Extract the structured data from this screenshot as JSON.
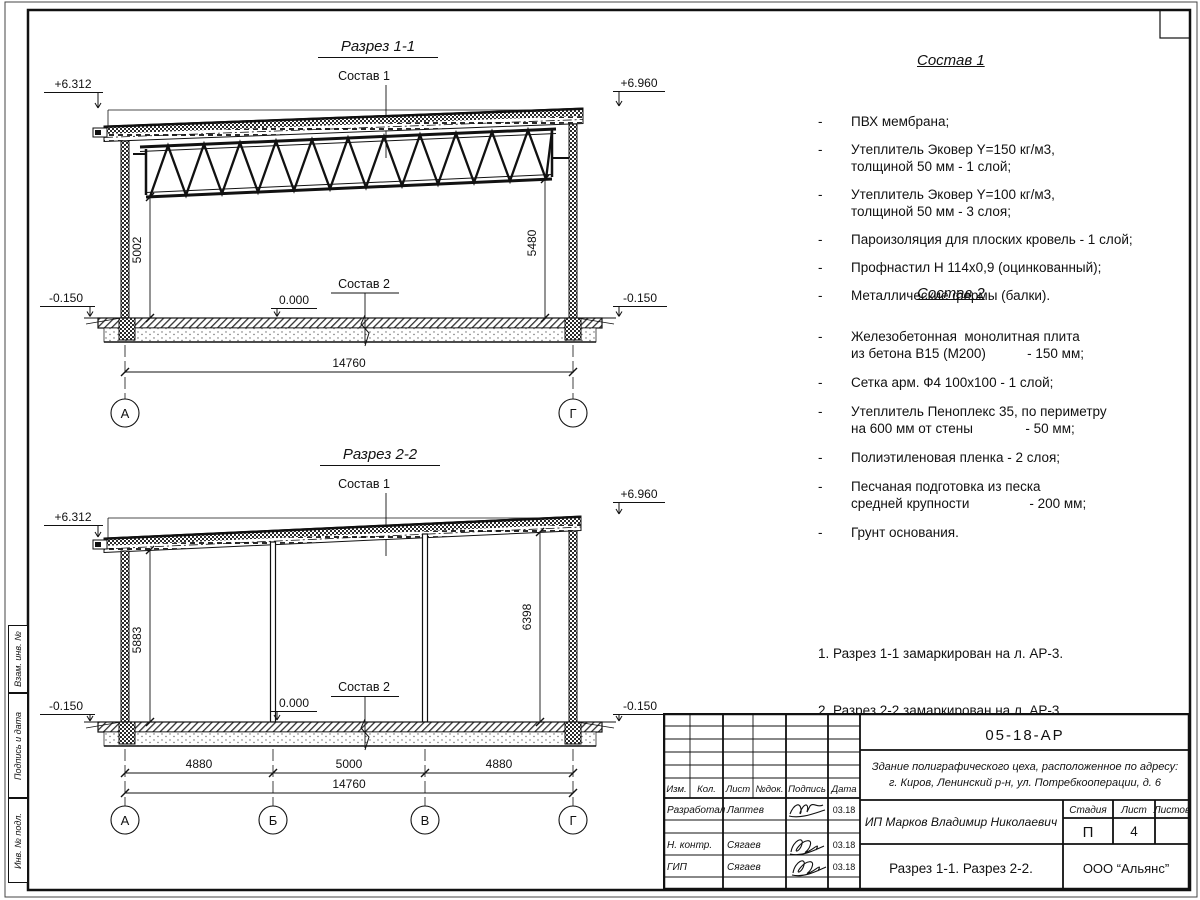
{
  "s1": {
    "title": "Разрез 1-1",
    "label_sostav1": "Состав 1",
    "label_sostav2": "Состав 2",
    "elev_tl": "+6.312",
    "elev_tr": "+6.960",
    "elev_zero": "0.000",
    "elev_bl": "-0.150",
    "elev_br": "-0.150",
    "dim_left": "5002",
    "dim_right": "5480",
    "dim_total": "14760",
    "axis_left": "А",
    "axis_right": "Г"
  },
  "s2": {
    "title": "Разрез 2-2",
    "label_sostav1": "Состав 1",
    "label_sostav2": "Состав 2",
    "elev_tl": "+6.312",
    "elev_tr": "+6.960",
    "elev_zero": "0.000",
    "elev_bl": "-0.150",
    "elev_br": "-0.150",
    "dim_left": "5883",
    "dim_right": "6398",
    "spans": [
      "4880",
      "5000",
      "4880"
    ],
    "dim_total": "14760",
    "axes": [
      "А",
      "Б",
      "В",
      "Г"
    ]
  },
  "lists": {
    "dash": "-",
    "s1_title": "Состав 1",
    "s1_items": [
      {
        "l1": "ПВХ мембрана;"
      },
      {
        "l1": "Утеплитель Эковер Y=150 кг/м3,",
        "l2": "толщиной 50 мм - 1 слой;"
      },
      {
        "l1": "Утеплитель Эковер Y=100 кг/м3,",
        "l2": "толщиной 50 мм - 3 слоя;"
      },
      {
        "l1": "Пароизоляция для плоских кровель - 1 слой;"
      },
      {
        "l1": "Профнастил Н 114х0,9 (оцинкованный);"
      },
      {
        "l1": "Металлические фермы (балки)."
      }
    ],
    "s2_title": "Состав 2",
    "s2_items": [
      {
        "l1": "Железобетонная  монолитная плита",
        "l2": "из бетона В15 (М200)           - 150 мм;"
      },
      {
        "l1": "Сетка арм. Ф4 100х100 - 1 слой;"
      },
      {
        "l1": "Утеплитель Пеноплекс 35, по периметру",
        "l2": "на 600 мм от стены              - 50 мм;"
      },
      {
        "l1": "Полиэтиленовая пленка - 2 слоя;"
      },
      {
        "l1": "Песчаная подготовка из песка",
        "l2": "средней крупности                - 200 мм;"
      },
      {
        "l1": "Грунт основания."
      }
    ]
  },
  "notes": [
    "1. Разрез 1-1 замаркирован на л. АР-3.",
    "2. Разрез 2-2 замаркирован на л. АР-3."
  ],
  "strip": [
    "Взам. инв. №",
    "Подпись и дата",
    "Инв. № подл."
  ],
  "stamp": {
    "doc": "05-18-АР",
    "obj1": "Здание полиграфического цеха, расположенное по адресу:",
    "obj2": "г. Киров,  Ленинский р-н, ул. Потребкооперации, д. 6",
    "client": "ИП Марков Владимир Николаевич",
    "drawing": "Разрез 1-1. Разрез 2-2.",
    "company": "ООО “Альянс”",
    "h_stage": "Стадия",
    "h_sheet": "Лист",
    "h_sheets": "Листов",
    "stage": "П",
    "sheet": "4",
    "sheets": "",
    "cols": [
      "Изм.",
      "Кол.",
      "Лист",
      "№док.",
      "Подпись",
      "Дата"
    ],
    "rows": [
      {
        "role": "Разработал",
        "name": "Лаптев",
        "date": "03.18"
      },
      {
        "role": "Н. контр.",
        "name": "Сягаев",
        "date": "03.18"
      },
      {
        "role": "ГИП",
        "name": "Сягаев",
        "date": "03.18"
      }
    ]
  }
}
